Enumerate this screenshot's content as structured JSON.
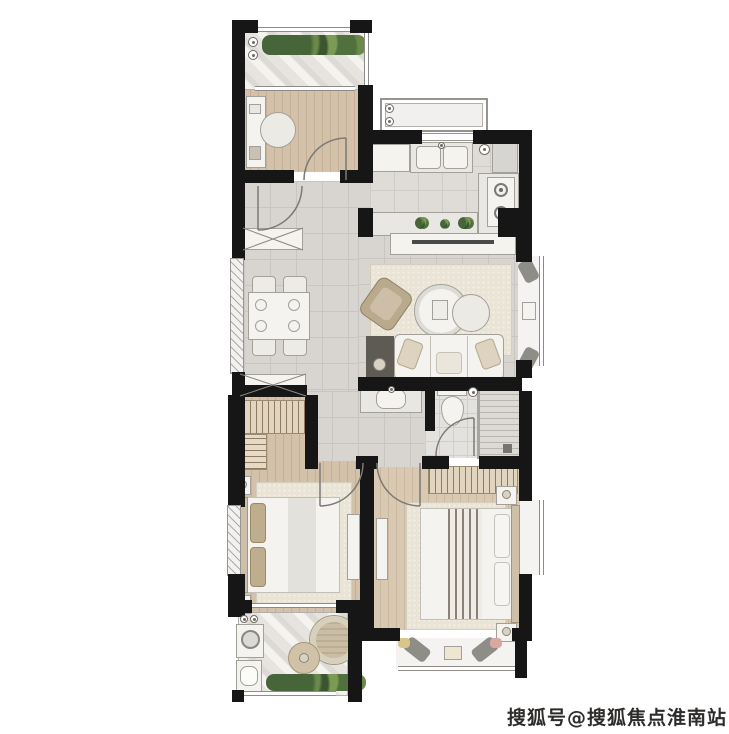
{
  "watermark": {
    "text": "搜狐号@搜狐焦点淮南站"
  },
  "palette": {
    "wall": "#161616",
    "tile": "#d8d5d0",
    "wood": "#d3c1a9",
    "wood_stripe": "#c3b096",
    "marble": "#e7e4df",
    "rug": "#eae4d7",
    "furniture_white": "#f4f3f0",
    "furniture_border": "#a3a09a",
    "accent_beige": "#b9aa8e",
    "plant_green": "#567a3e",
    "line_gray": "#8a8a8a"
  },
  "icons": {
    "washing_machine": "drum-circle",
    "stove": "two-burners",
    "sink": "double-basin",
    "toilet": "tank-and-bowl",
    "floor_drain": "circle-dot"
  }
}
